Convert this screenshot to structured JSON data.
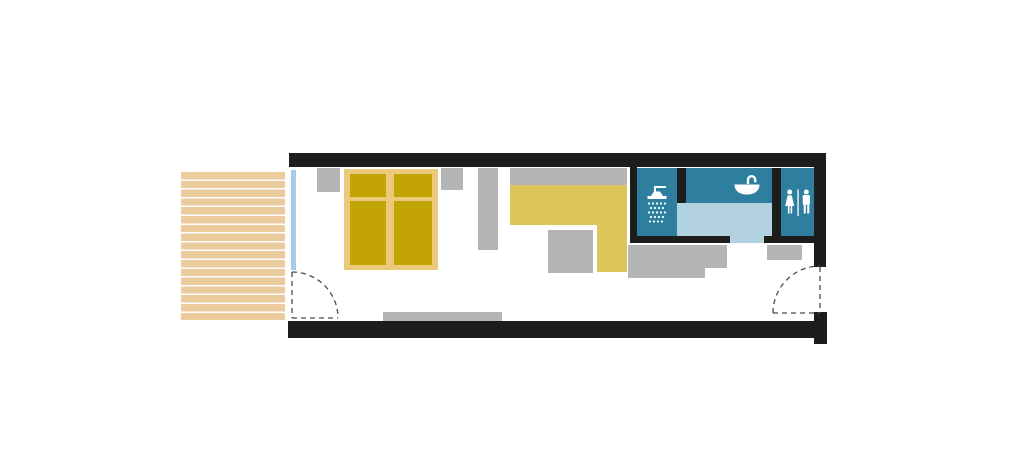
{
  "meta": {
    "title": "Studio cabin floor plan with deck, double bed, kitchenette and bathroom",
    "diagram_type": "architectural-floor-plan",
    "visible_text": []
  },
  "colors": {
    "background": "#ffffff",
    "wall": "#1d1d1b",
    "furniture": "#b5b5b5",
    "deck": "#eccb9d",
    "deck_gap": "#ffffff",
    "bed_frame": "#ebc97d",
    "mattress": "#c2a404",
    "counter": "#dcc65c",
    "bath_tile": "#2e7f9f",
    "bath_floor": "#b2d1e1",
    "window": "#a5cbe6",
    "icon": "#ffffff",
    "door_dash": "#4a4a4a"
  },
  "icons": {
    "shower": "shower-icon",
    "washbasin": "washbasin-icon",
    "restroom": "restroom-icon"
  }
}
